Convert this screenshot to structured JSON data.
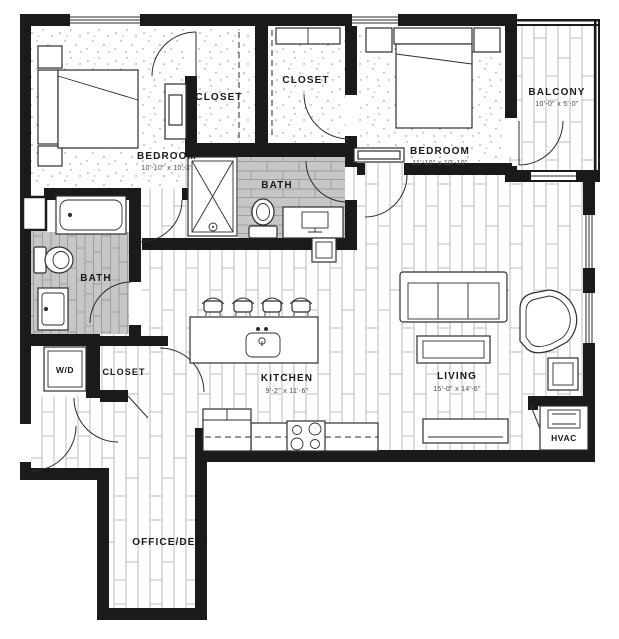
{
  "plan": {
    "type": "apartment-floor-plan",
    "colors": {
      "wall": "#1a1a1a",
      "tile": "#c6c6c6",
      "line": "#2e2e2e",
      "floor": "#ffffff"
    },
    "rooms": [
      {
        "label": "BEDROOM",
        "dims": "10'-10\" x 10'-3\""
      },
      {
        "label": "CLOSET",
        "dims": ""
      },
      {
        "label": "CLOSET",
        "dims": ""
      },
      {
        "label": "BEDROOM",
        "dims": "11'-10\" x 10'-10\""
      },
      {
        "label": "BALCONY",
        "dims": "10'-0\" x 5'-0\""
      },
      {
        "label": "BATH",
        "dims": ""
      },
      {
        "label": "BATH",
        "dims": ""
      },
      {
        "label": "W/D",
        "dims": ""
      },
      {
        "label": "CLOSET",
        "dims": ""
      },
      {
        "label": "KITCHEN",
        "dims": "9'-2\" x 11'-6\""
      },
      {
        "label": "LIVING",
        "dims": "15'-0\" x 14'-6\""
      },
      {
        "label": "HVAC",
        "dims": ""
      },
      {
        "label": "OFFICE/DEN",
        "dims": ""
      }
    ]
  }
}
